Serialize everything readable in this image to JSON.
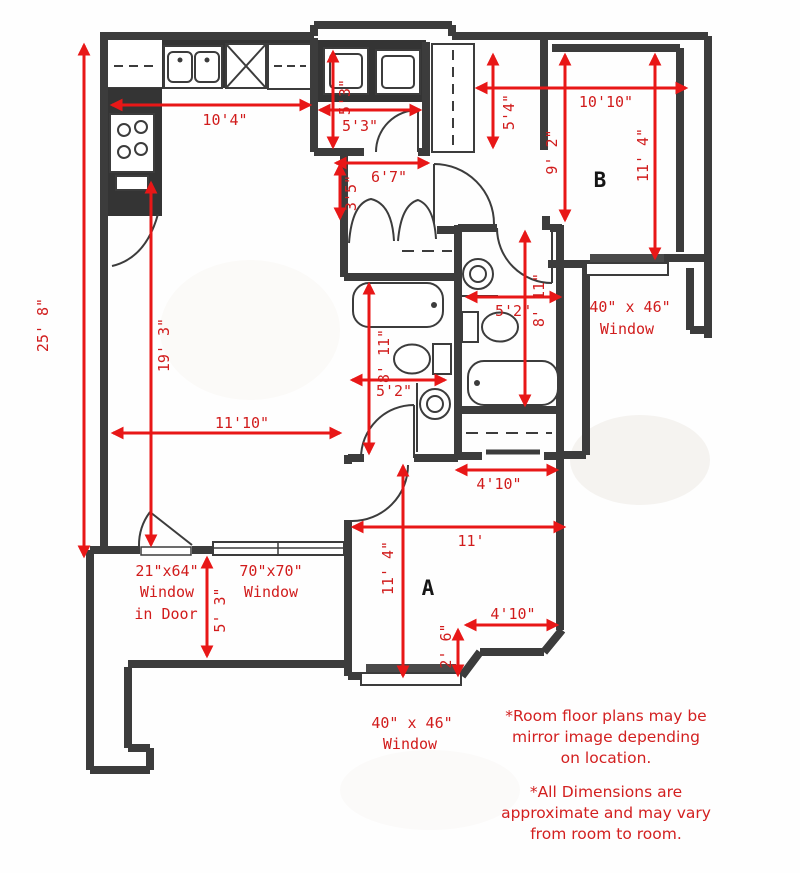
{
  "plan_title": "Apartment floor plan",
  "rooms": {
    "a": "A",
    "b": "B"
  },
  "dims": {
    "left_total": "25' 8\"",
    "living_length": "19' 3\"",
    "kitchen_width": "10'4\"",
    "utility_depth": "5'3\"",
    "utility_width": "5'3\"",
    "hall_width": "6'7\"",
    "hall_depth": "3'5\"",
    "entry_depth": "5'4\"",
    "roomb_width": "10'10\"",
    "roomb_depth": "9' 2\"",
    "roomb_length": "11' 4\"",
    "bath2_length": "8' 11\"",
    "bath2_width": "5'2\"",
    "bath1_length": "8' 11\"",
    "bath1_width": "5'2\"",
    "living_width": "11'10\"",
    "closet_width": "4'10\"",
    "rooma_width": "11'",
    "rooma_length": "11' 4\"",
    "balcony_depth": "5' 3\"",
    "notch_width": "4'10\"",
    "notch_depth": "2' 6\""
  },
  "windows": {
    "right": [
      "40\" x 46\"",
      "Window"
    ],
    "door": [
      "21\"x64\"",
      "Window",
      "in Door"
    ],
    "patio": [
      "70\"x70\"",
      "Window"
    ],
    "bottom": [
      "40\" x 46\"",
      "Window"
    ]
  },
  "notes": {
    "mirror": [
      "*Room floor plans may be",
      "mirror image depending",
      "on location."
    ],
    "approx": [
      "*All Dimensions are",
      "approximate and may vary",
      "from room to room."
    ]
  },
  "colors": {
    "dimension_red": "#e81717",
    "label_red": "#d11c1c",
    "wall_gray": "#3c3c3c"
  }
}
